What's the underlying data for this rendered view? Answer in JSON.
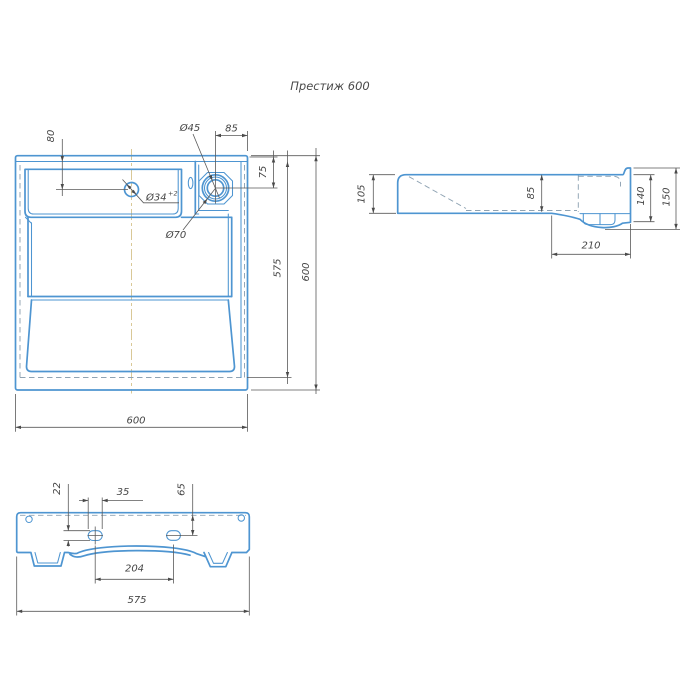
{
  "title": "Престиж 600",
  "colors": {
    "drawing_line": "#4e95d1",
    "dimension_line": "#5a5a5a",
    "hidden_line": "#8fa3b3",
    "centerline": "#d9c897",
    "background": "#ffffff"
  },
  "plan_view": {
    "name": "top-view",
    "dims": {
      "d80": "80",
      "d45": "Ø45",
      "d85": "85",
      "d34": "Ø34",
      "d34_tol": "+2",
      "d75": "75",
      "d70": "Ø70",
      "d575": "575",
      "d600_right": "600",
      "d600_bottom": "600"
    }
  },
  "side_view": {
    "name": "side-view",
    "dims": {
      "d105": "105",
      "d85": "85",
      "d140": "140",
      "d150": "150",
      "d210": "210"
    }
  },
  "front_view": {
    "name": "front-bottom-view",
    "dims": {
      "d22": "22",
      "d35": "35",
      "d65": "65",
      "d204": "204",
      "d575": "575"
    }
  }
}
